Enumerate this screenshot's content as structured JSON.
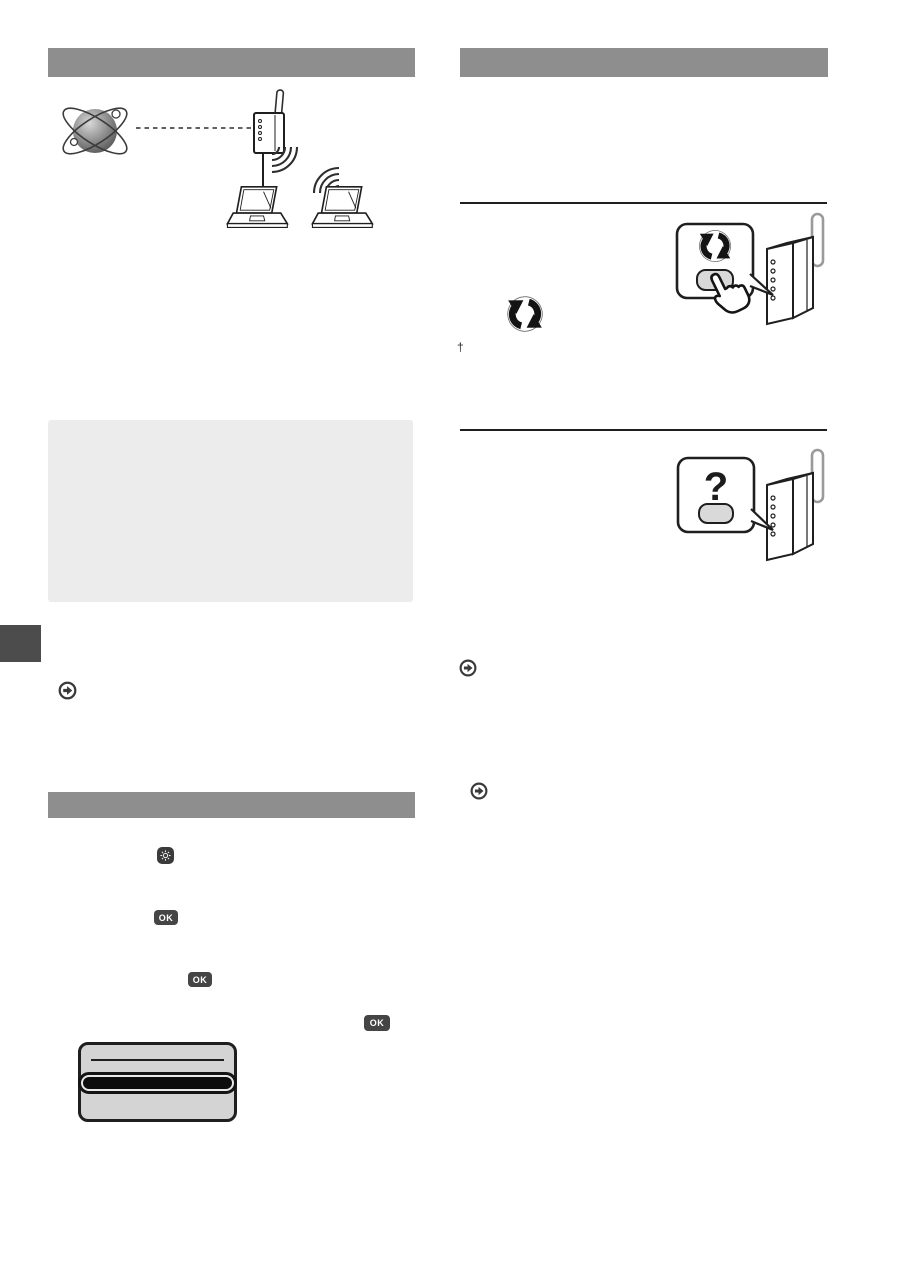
{
  "page": {
    "background": "#ffffff"
  },
  "colors": {
    "section_bar": "#8e8e8e",
    "note_box": "#ececec",
    "edge_tab": "#4c4c4c",
    "key_dark": "#454545",
    "key_label": "#ffffff",
    "line_art": "#1f1f1f",
    "lcd_background": "#d4d4d4",
    "lcd_selected_fill": "#0d0d0d",
    "callout_button": "#d9d9d9"
  },
  "left_column": {
    "section_bar_top": {
      "label": ""
    },
    "network_illustration": {
      "description": "internet globe linked by dashed line to wireless router, wired to one laptop and wireless to another",
      "icons": [
        "internet-globe-icon",
        "wireless-router-icon",
        "wifi-waves-icon",
        "laptop-icon",
        "laptop-icon"
      ]
    },
    "note_box": {
      "text": ""
    },
    "edge_tab": {
      "label": ""
    },
    "reference_arrow": {
      "icon": "circled-arrow-icon",
      "text": ""
    },
    "section_bar_bottom": {
      "label": ""
    },
    "step_keys": {
      "menu_key": {
        "icon": "gear-key-icon",
        "label": ""
      },
      "ok_keys": [
        {
          "label": "OK"
        },
        {
          "label": "OK"
        },
        {
          "label": "OK"
        }
      ]
    },
    "lcd_display": {
      "title_text": "",
      "selected_item_text": ""
    }
  },
  "right_column": {
    "section_bar_top": {
      "label": ""
    },
    "wps_section": {
      "inline_wps_icon": "wps-logo-icon",
      "footnote_marker": "†",
      "callout": {
        "icon": "wps-logo-icon",
        "button_label": ""
      },
      "router_icon": "wireless-router-3d-icon",
      "finger_icon": "pressing-finger-icon"
    },
    "manual_section": {
      "callout": {
        "question_mark": "?",
        "button_label": ""
      },
      "router_icon": "wireless-router-3d-icon"
    },
    "reference_arrows": [
      {
        "icon": "circled-arrow-icon",
        "text": ""
      },
      {
        "icon": "circled-arrow-icon",
        "text": ""
      }
    ]
  }
}
